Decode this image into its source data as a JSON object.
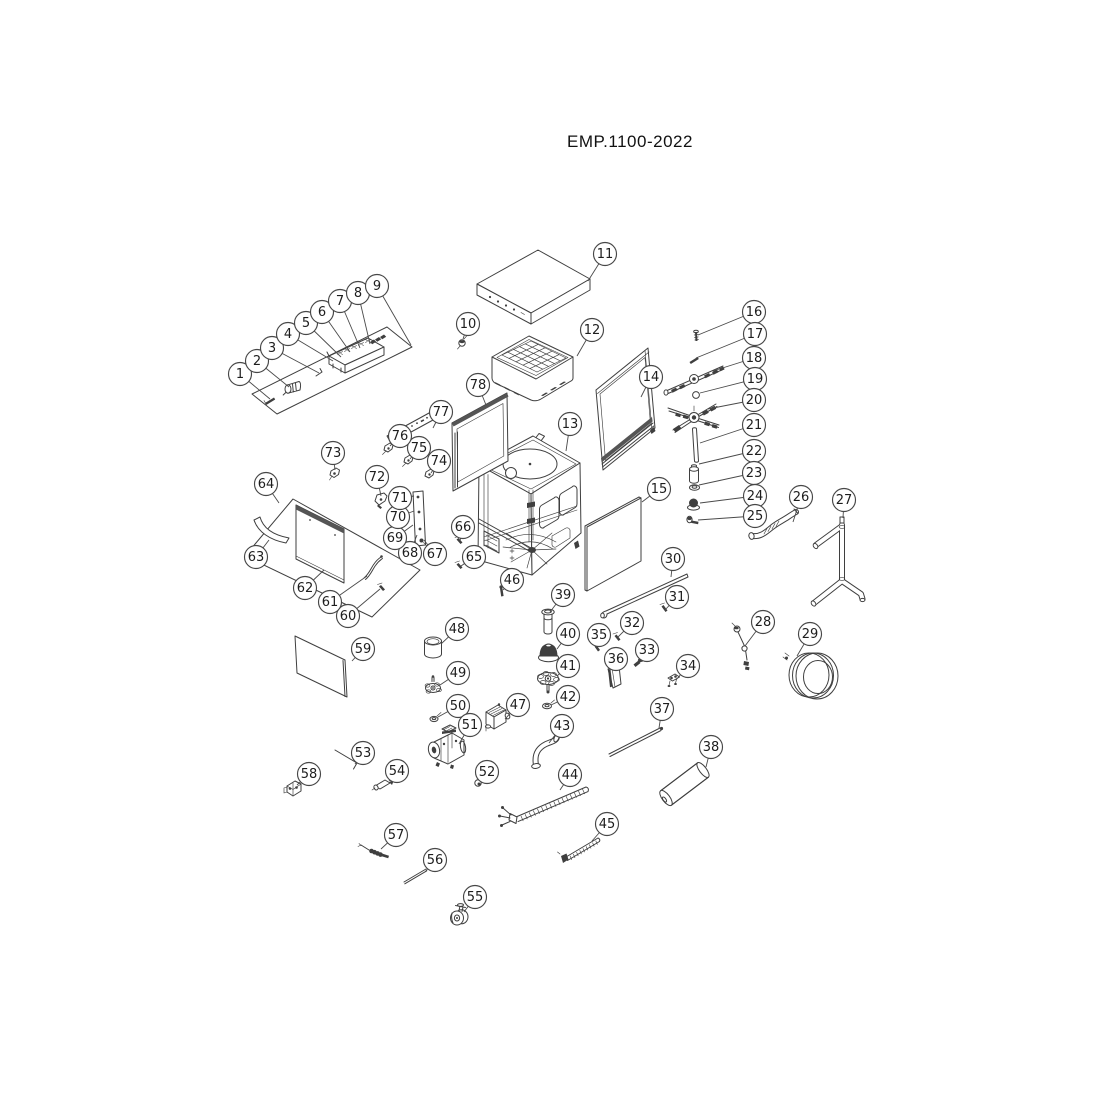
{
  "title": "EMP.1100-2022",
  "colors": {
    "line": "#3f3f3f",
    "dark_fill": "#3f3f3f",
    "background": "#ffffff"
  },
  "callouts": [
    {
      "n": 1,
      "cx": 240,
      "cy": 374,
      "tx": 270,
      "ty": 399
    },
    {
      "n": 2,
      "cx": 257,
      "cy": 361,
      "tx": 289,
      "ty": 387
    },
    {
      "n": 3,
      "cx": 272,
      "cy": 348,
      "tx": 319,
      "ty": 373
    },
    {
      "n": 4,
      "cx": 288,
      "cy": 334,
      "tx": 333,
      "ty": 361
    },
    {
      "n": 5,
      "cx": 306,
      "cy": 323,
      "tx": 341,
      "ty": 357
    },
    {
      "n": 6,
      "cx": 322,
      "cy": 312,
      "tx": 350,
      "ty": 352
    },
    {
      "n": 7,
      "cx": 340,
      "cy": 301,
      "tx": 360,
      "ty": 348
    },
    {
      "n": 8,
      "cx": 358,
      "cy": 293,
      "tx": 370,
      "ty": 344
    },
    {
      "n": 9,
      "cx": 377,
      "cy": 286,
      "tx": 411,
      "ty": 345
    },
    {
      "n": 10,
      "cx": 468,
      "cy": 324,
      "tx": 463,
      "ty": 339
    },
    {
      "n": 11,
      "cx": 605,
      "cy": 254,
      "tx": 588,
      "ty": 281
    },
    {
      "n": 12,
      "cx": 592,
      "cy": 330,
      "tx": 577,
      "ty": 356
    },
    {
      "n": 13,
      "cx": 570,
      "cy": 424,
      "tx": 566,
      "ty": 451
    },
    {
      "n": 14,
      "cx": 651,
      "cy": 377,
      "tx": 641,
      "ty": 397
    },
    {
      "n": 15,
      "cx": 659,
      "cy": 489,
      "tx": 642,
      "ty": 502
    },
    {
      "n": 16,
      "cx": 754,
      "cy": 312,
      "tx": 698,
      "ty": 335
    },
    {
      "n": 17,
      "cx": 755,
      "cy": 334,
      "tx": 696,
      "ty": 358
    },
    {
      "n": 18,
      "cx": 754,
      "cy": 358,
      "tx": 713,
      "ty": 371
    },
    {
      "n": 19,
      "cx": 755,
      "cy": 379,
      "tx": 700,
      "ty": 393
    },
    {
      "n": 20,
      "cx": 754,
      "cy": 400,
      "tx": 708,
      "ty": 409
    },
    {
      "n": 21,
      "cx": 754,
      "cy": 425,
      "tx": 700,
      "ty": 443
    },
    {
      "n": 22,
      "cx": 754,
      "cy": 451,
      "tx": 699,
      "ty": 464
    },
    {
      "n": 23,
      "cx": 754,
      "cy": 473,
      "tx": 699,
      "ty": 485
    },
    {
      "n": 24,
      "cx": 755,
      "cy": 496,
      "tx": 700,
      "ty": 503
    },
    {
      "n": 25,
      "cx": 755,
      "cy": 516,
      "tx": 698,
      "ty": 520
    },
    {
      "n": 26,
      "cx": 801,
      "cy": 497,
      "tx": 793,
      "ty": 522
    },
    {
      "n": 27,
      "cx": 844,
      "cy": 500,
      "tx": 843,
      "ty": 518
    },
    {
      "n": 28,
      "cx": 763,
      "cy": 622,
      "tx": 745,
      "ty": 646
    },
    {
      "n": 29,
      "cx": 810,
      "cy": 634,
      "tx": 797,
      "ty": 656
    },
    {
      "n": 30,
      "cx": 673,
      "cy": 559,
      "tx": 671,
      "ty": 577
    },
    {
      "n": 31,
      "cx": 677,
      "cy": 597,
      "tx": 665,
      "ty": 610
    },
    {
      "n": 32,
      "cx": 632,
      "cy": 623,
      "tx": 618,
      "ty": 637
    },
    {
      "n": 33,
      "cx": 647,
      "cy": 650,
      "tx": 638,
      "ty": 661
    },
    {
      "n": 34,
      "cx": 688,
      "cy": 666,
      "tx": 676,
      "ty": 680
    },
    {
      "n": 35,
      "cx": 599,
      "cy": 635,
      "tx": 597,
      "ty": 647
    },
    {
      "n": 36,
      "cx": 616,
      "cy": 659,
      "tx": 615,
      "ty": 671
    },
    {
      "n": 37,
      "cx": 662,
      "cy": 709,
      "tx": 659,
      "ty": 728
    },
    {
      "n": 38,
      "cx": 711,
      "cy": 747,
      "tx": 706,
      "ty": 767
    },
    {
      "n": 39,
      "cx": 563,
      "cy": 595,
      "tx": 550,
      "ty": 612
    },
    {
      "n": 40,
      "cx": 568,
      "cy": 634,
      "tx": 557,
      "ty": 649
    },
    {
      "n": 41,
      "cx": 568,
      "cy": 666,
      "tx": 557,
      "ty": 676
    },
    {
      "n": 42,
      "cx": 568,
      "cy": 697,
      "tx": 551,
      "ty": 705
    },
    {
      "n": 43,
      "cx": 562,
      "cy": 726,
      "tx": 549,
      "ty": 743
    },
    {
      "n": 44,
      "cx": 570,
      "cy": 775,
      "tx": 560,
      "ty": 790
    },
    {
      "n": 45,
      "cx": 607,
      "cy": 824,
      "tx": 592,
      "ty": 841
    },
    {
      "n": 46,
      "cx": 512,
      "cy": 580,
      "tx": 503,
      "ty": 590
    },
    {
      "n": 47,
      "cx": 518,
      "cy": 705,
      "tx": 505,
      "ty": 719
    },
    {
      "n": 48,
      "cx": 457,
      "cy": 629,
      "tx": 441,
      "ty": 644
    },
    {
      "n": 49,
      "cx": 458,
      "cy": 673,
      "tx": 440,
      "ty": 685
    },
    {
      "n": 50,
      "cx": 458,
      "cy": 706,
      "tx": 438,
      "ty": 717
    },
    {
      "n": 51,
      "cx": 470,
      "cy": 725,
      "tx": 459,
      "ty": 744
    },
    {
      "n": 52,
      "cx": 487,
      "cy": 772,
      "tx": 480,
      "ty": 781
    },
    {
      "n": 53,
      "cx": 363,
      "cy": 753,
      "tx": 355,
      "ty": 764
    },
    {
      "n": 54,
      "cx": 397,
      "cy": 771,
      "tx": 389,
      "ty": 781
    },
    {
      "n": 55,
      "cx": 475,
      "cy": 897,
      "tx": 464,
      "ty": 912
    },
    {
      "n": 56,
      "cx": 435,
      "cy": 860,
      "tx": 425,
      "ty": 872
    },
    {
      "n": 57,
      "cx": 396,
      "cy": 835,
      "tx": 381,
      "ty": 849
    },
    {
      "n": 58,
      "cx": 309,
      "cy": 774,
      "tx": 297,
      "ty": 785
    },
    {
      "n": 59,
      "cx": 363,
      "cy": 649,
      "tx": 352,
      "ty": 661
    },
    {
      "n": 60,
      "cx": 348,
      "cy": 616,
      "tx": 380,
      "ty": 589
    },
    {
      "n": 61,
      "cx": 330,
      "cy": 602,
      "tx": 367,
      "ty": 576
    },
    {
      "n": 62,
      "cx": 305,
      "cy": 588,
      "tx": 324,
      "ty": 570
    },
    {
      "n": 63,
      "cx": 256,
      "cy": 557,
      "tx": 269,
      "ty": 540
    },
    {
      "n": 64,
      "cx": 266,
      "cy": 484,
      "tx": 279,
      "ty": 503
    },
    {
      "n": 65,
      "cx": 474,
      "cy": 557,
      "tx": 461,
      "ty": 566
    },
    {
      "n": 66,
      "cx": 463,
      "cy": 527,
      "tx": 460,
      "ty": 541
    },
    {
      "n": 67,
      "cx": 435,
      "cy": 554,
      "tx": 424,
      "ty": 540
    },
    {
      "n": 68,
      "cx": 410,
      "cy": 553,
      "tx": 417,
      "ty": 535
    },
    {
      "n": 69,
      "cx": 395,
      "cy": 538,
      "tx": 413,
      "ty": 525
    },
    {
      "n": 70,
      "cx": 398,
      "cy": 517,
      "tx": 414,
      "ty": 511
    },
    {
      "n": 71,
      "cx": 400,
      "cy": 498,
      "tx": 414,
      "ty": 496
    },
    {
      "n": 72,
      "cx": 377,
      "cy": 477,
      "tx": 381,
      "ty": 496
    },
    {
      "n": 73,
      "cx": 333,
      "cy": 453,
      "tx": 335,
      "ty": 470
    },
    {
      "n": 74,
      "cx": 439,
      "cy": 461,
      "tx": 431,
      "ty": 473
    },
    {
      "n": 75,
      "cx": 419,
      "cy": 448,
      "tx": 410,
      "ty": 459
    },
    {
      "n": 76,
      "cx": 400,
      "cy": 436,
      "tx": 390,
      "ty": 446
    },
    {
      "n": 77,
      "cx": 441,
      "cy": 412,
      "tx": 433,
      "ty": 428
    },
    {
      "n": 78,
      "cx": 478,
      "cy": 385,
      "tx": 486,
      "ty": 405
    }
  ]
}
